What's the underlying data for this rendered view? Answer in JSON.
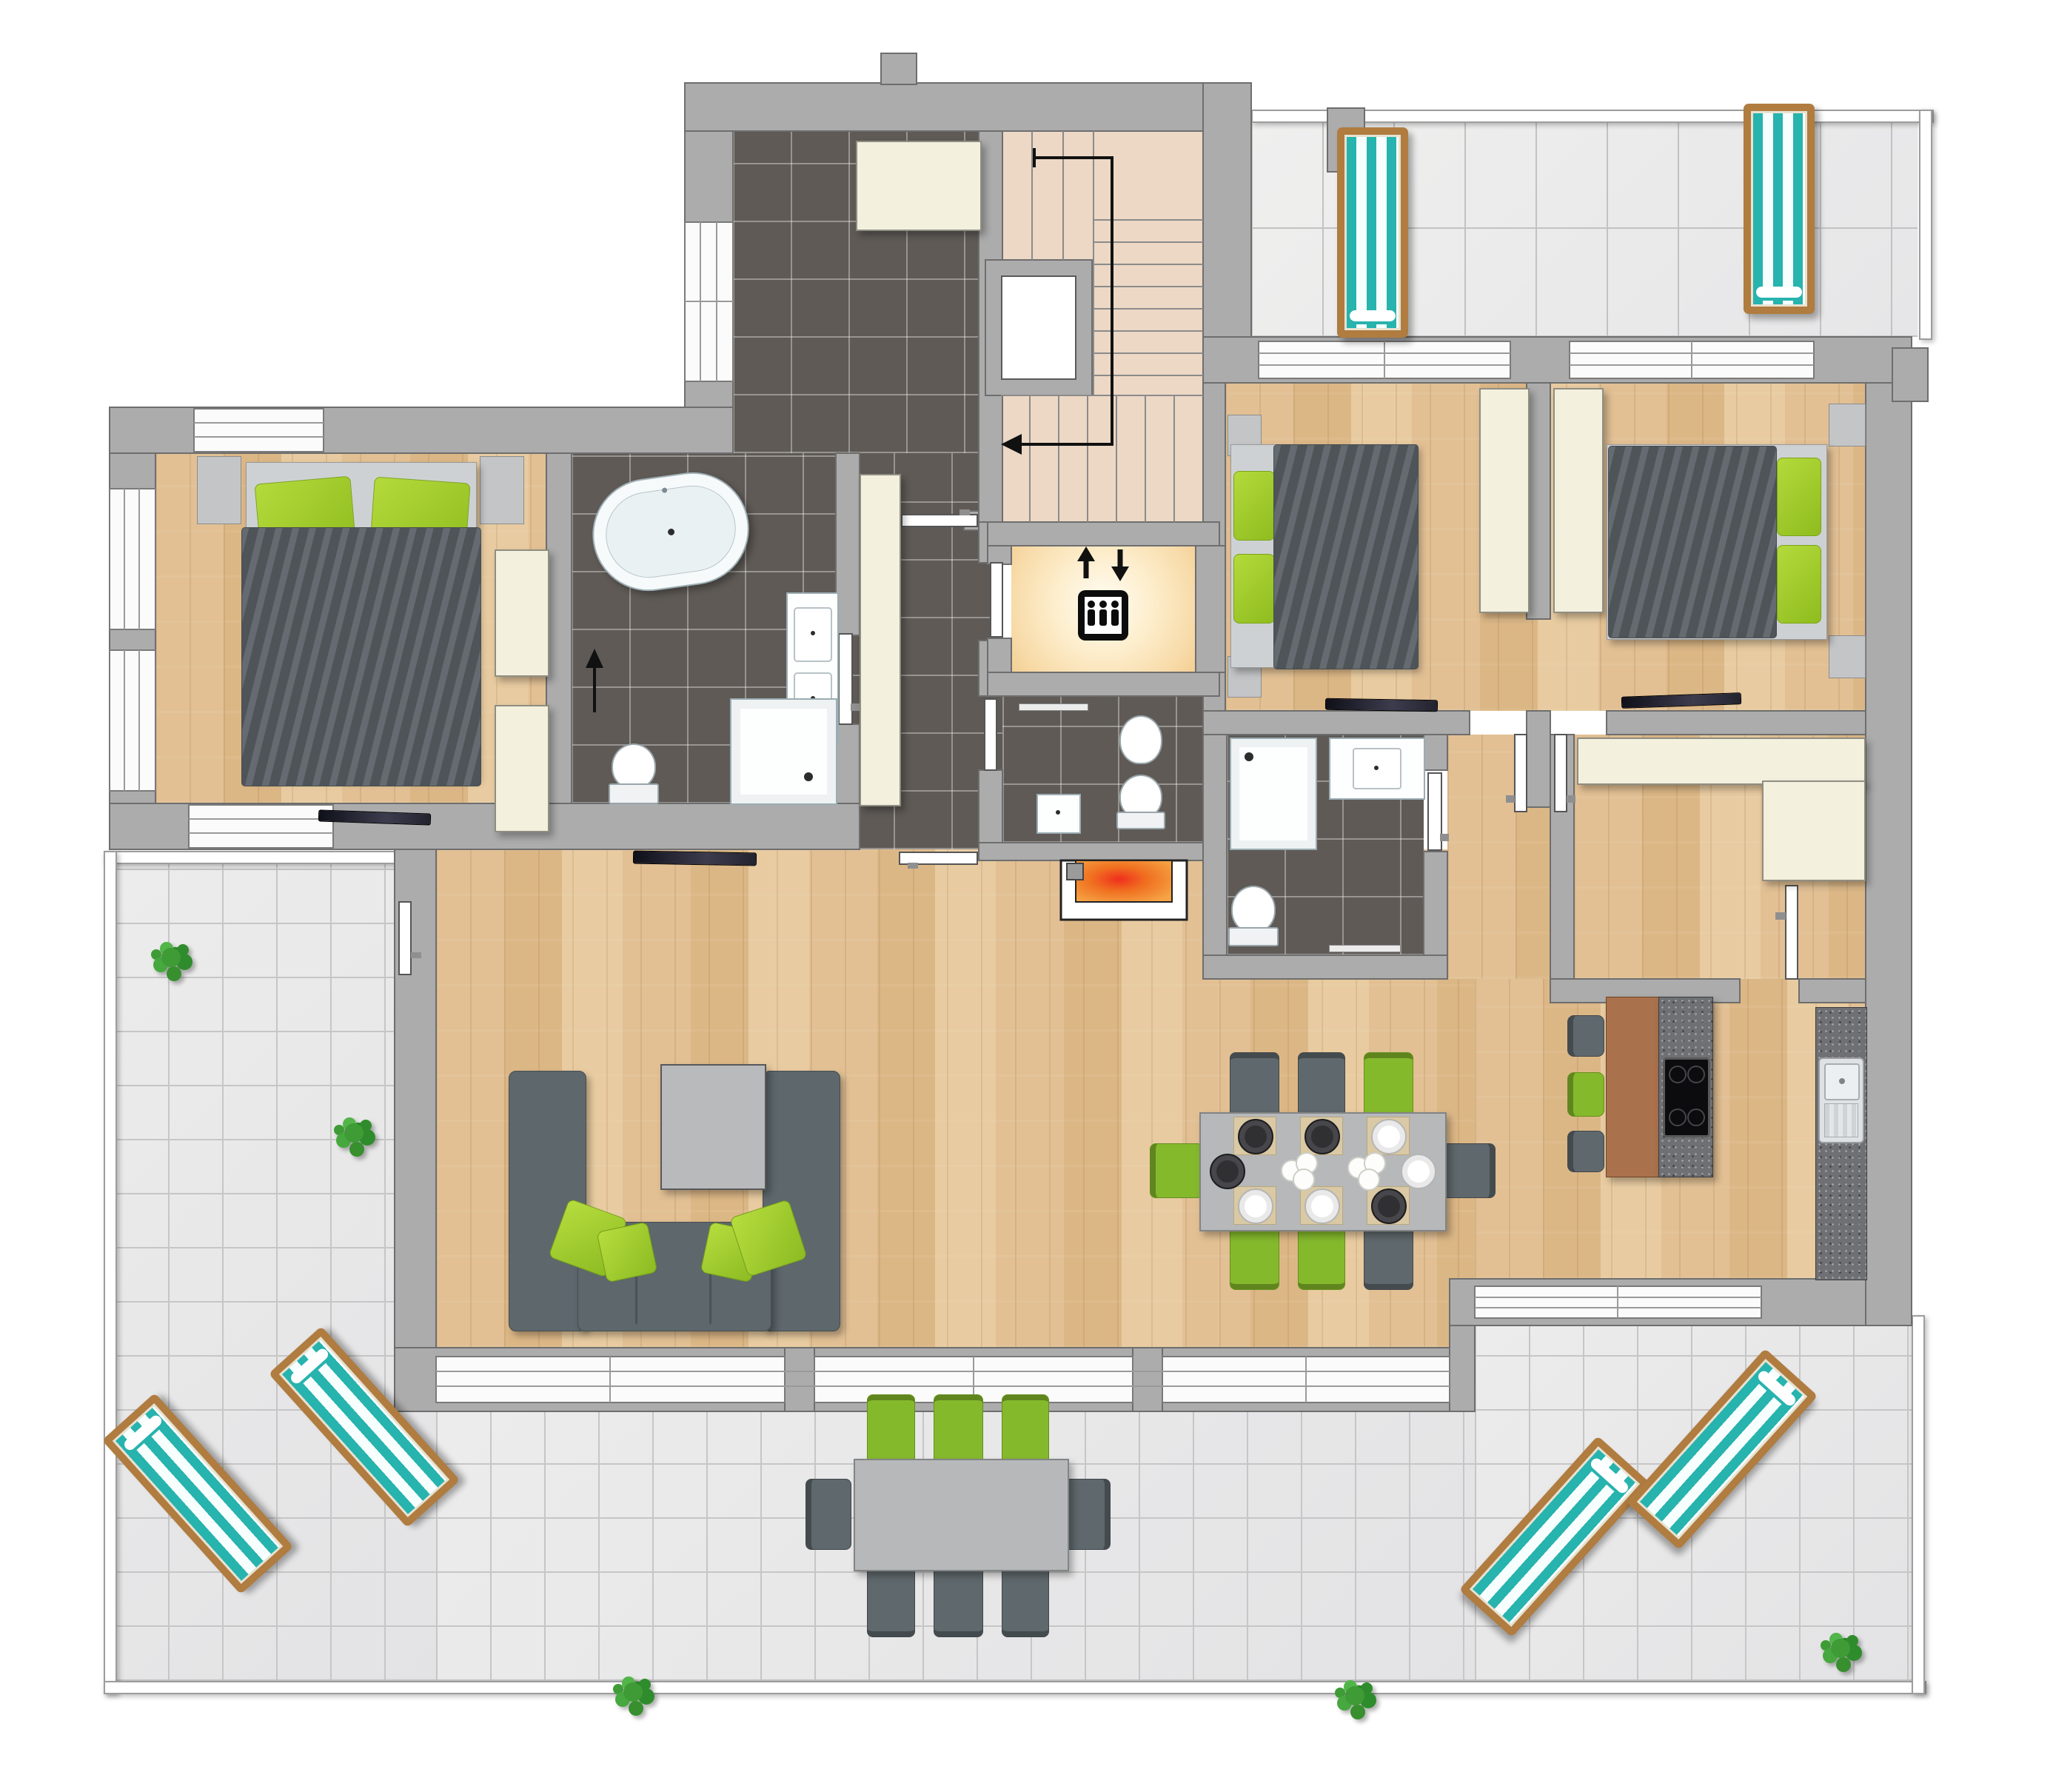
{
  "meta": {
    "type": "residential floor plan, top-down 2D render",
    "visible_text": [],
    "storey": "penthouse level with wrap-around roof terraces"
  },
  "colors": {
    "wall": "#acacac",
    "wall_outline": "#6e6e6e",
    "wood": "#e2c094",
    "dark_tile": "#5f5a56",
    "terrace_tile": "#ececec",
    "stair": "#ecd8c5",
    "cream": "#f4f0de",
    "glow": "#f3cf93",
    "accent_green": "#8fbc1f",
    "sofa_gray": "#5d676c",
    "duvet_gray": "#5b6267",
    "teal": "#27b3ae",
    "lounger_wood": "#b07c3f",
    "island_brown": "#a9714c",
    "granite": "#6f7074",
    "fire_orange": "#f25022",
    "window_white": "#fbfbfb"
  },
  "icons": [
    "elevator-icon",
    "elevator-up-arrow-icon",
    "elevator-down-arrow-icon",
    "stair-direction-arrow-icon",
    "bathroom-entry-arrow-icon"
  ],
  "rooms": [
    {
      "name": "hallway",
      "floor": "dark tile",
      "furniture": [
        "built-in-closet",
        "tall-cabinet",
        "glass-door"
      ]
    },
    {
      "name": "staircase",
      "floor": "beige steps",
      "furniture": [
        "stairwell-void",
        "direction-arrow"
      ]
    },
    {
      "name": "elevator",
      "floor": "warm glow",
      "furniture": [
        "elevator-pictogram"
      ]
    },
    {
      "name": "wc",
      "floor": "dark tile",
      "furniture": [
        "toilet",
        "bidet",
        "hand-basin",
        "towel-rail"
      ]
    },
    {
      "name": "bedroom-left",
      "floor": "wood",
      "furniture": [
        "double-bed",
        "green-pillows",
        "nightstand x2",
        "wardrobe x2",
        "tv"
      ]
    },
    {
      "name": "main-bathroom",
      "floor": "dark tile",
      "furniture": [
        "freestanding-oval-bathtub",
        "double-washbasin",
        "shower",
        "toilet",
        "entry-arrow"
      ]
    },
    {
      "name": "bedroom-middle",
      "floor": "wood",
      "furniture": [
        "double-bed",
        "green-pillows",
        "nightstand x2",
        "wardrobe",
        "tv"
      ]
    },
    {
      "name": "bedroom-right",
      "floor": "wood",
      "furniture": [
        "double-bed",
        "green-pillows",
        "nightstand x2",
        "wardrobe",
        "tv"
      ]
    },
    {
      "name": "ensuite-bathroom",
      "floor": "dark tile",
      "furniture": [
        "shower",
        "washbasin",
        "toilet",
        "towel-rail"
      ]
    },
    {
      "name": "walk-in-closet",
      "floor": "wood",
      "furniture": [
        "l-shaped-wardrobe"
      ]
    },
    {
      "name": "living-area",
      "floor": "wood",
      "furniture": [
        "u-shaped-sofa",
        "green-cushions x4",
        "coffee-table",
        "wall-tv",
        "fireplace"
      ]
    },
    {
      "name": "dining-area",
      "floor": "wood",
      "furniture": [
        "dining-table",
        "chairs x8 (3 green, 5 gray)",
        "place-settings x8",
        "flower-centerpiece x2"
      ]
    },
    {
      "name": "kitchen",
      "floor": "wood",
      "furniture": [
        "island with wood top + granite cooktop",
        "bar-stool x3 (gray, green, gray)",
        "granite-counter",
        "stainless-sink"
      ]
    }
  ],
  "terraces": [
    {
      "name": "terrace-top-right",
      "floor": "large tiles",
      "furniture": [
        "sun-lounger x2 (teal striped)",
        "utility-block x2"
      ]
    },
    {
      "name": "terrace-wraparound",
      "floor": "square tiles",
      "furniture": [
        "sun-lounger x4 (teal striped)",
        "outdoor-table",
        "outdoor-chair x8 (3 green, 5 gray)",
        "plant x5"
      ]
    }
  ],
  "counts": {
    "sun_loungers": 6,
    "beds": 3,
    "bathrooms": 3,
    "plants": 5,
    "dining_seats": 8,
    "bar_stools": 3,
    "outdoor_seats": 8
  }
}
